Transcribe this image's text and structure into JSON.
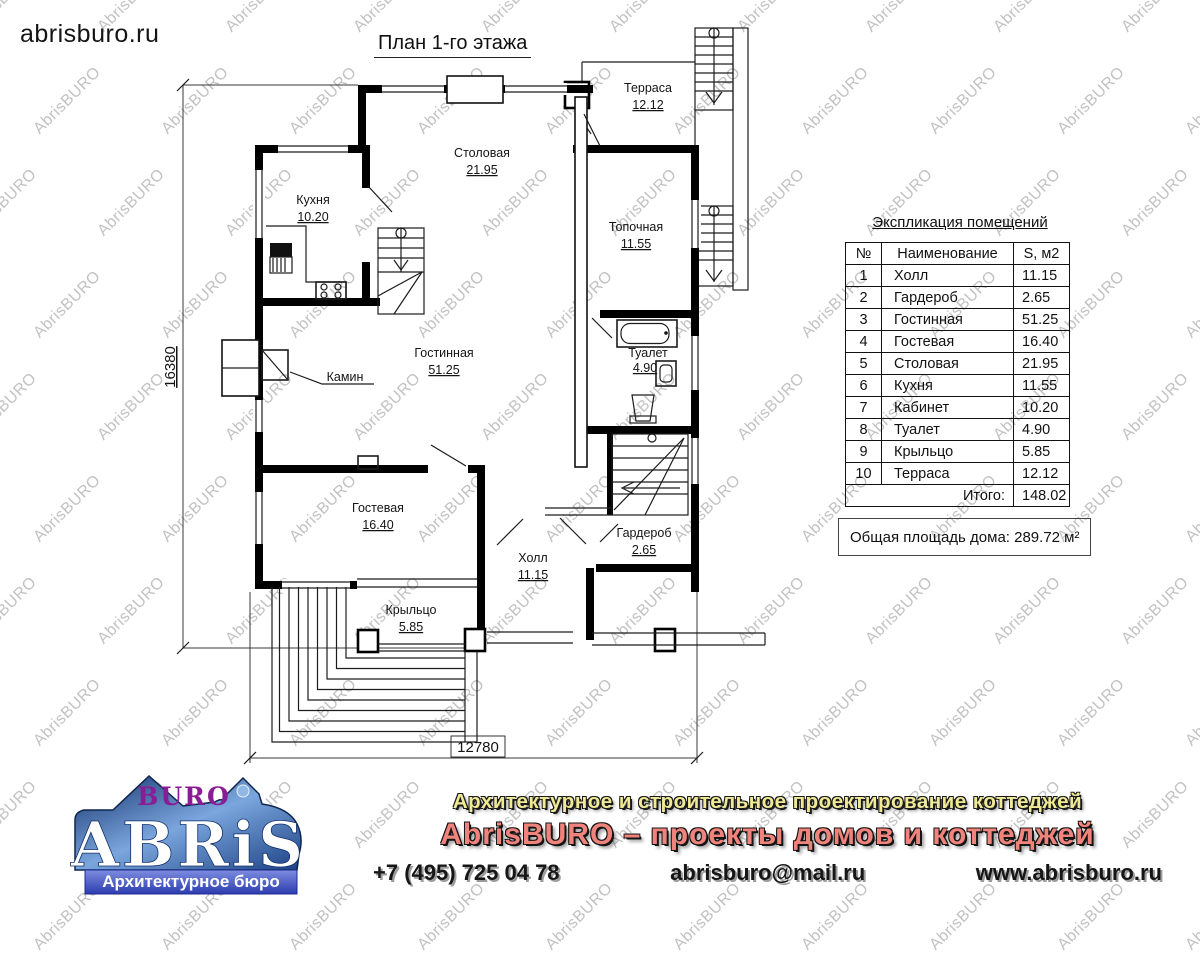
{
  "header": {
    "site": "abrisburo.ru",
    "title": "План 1-го этажа"
  },
  "watermark": {
    "text": "AbrisBURO",
    "color": "#c2c2c2"
  },
  "plan": {
    "dims": {
      "height": "16380",
      "width": "12780"
    },
    "labels": {
      "terrace": {
        "name": "Терраса",
        "area": "12.12"
      },
      "dining": {
        "name": "Столовая",
        "area": "21.95"
      },
      "kitchen": {
        "name": "Кухня",
        "area": "10.20"
      },
      "boiler": {
        "name": "Топочная",
        "area": "11.55"
      },
      "living": {
        "name": "Гостинная",
        "area": "51.25"
      },
      "fireplace": {
        "name": "Камин"
      },
      "toilet": {
        "name": "Туалет",
        "area": "4.90"
      },
      "guest": {
        "name": "Гостевая",
        "area": "16.40"
      },
      "hall": {
        "name": "Холл",
        "area": "11.15"
      },
      "wardrobe": {
        "name": "Гардероб",
        "area": "2.65"
      },
      "porch": {
        "name": "Крыльцо",
        "area": "5.85"
      }
    }
  },
  "explication": {
    "title": "Экспликация помещений",
    "headers": [
      "№",
      "Наименование",
      "S, м2"
    ],
    "rows": [
      [
        "1",
        "Холл",
        "11.15"
      ],
      [
        "2",
        "Гардероб",
        "2.65"
      ],
      [
        "3",
        "Гостинная",
        "51.25"
      ],
      [
        "4",
        "Гостевая",
        "16.40"
      ],
      [
        "5",
        "Столовая",
        "21.95"
      ],
      [
        "6",
        "Кухня",
        "11.55"
      ],
      [
        "7",
        "Кабинет",
        "10.20"
      ],
      [
        "8",
        "Туалет",
        "4.90"
      ],
      [
        "9",
        "Крыльцо",
        "5.85"
      ],
      [
        "10",
        "Терраса",
        "12.12"
      ]
    ],
    "total_label": "Итого:",
    "total_value": "148.02"
  },
  "summary": {
    "text": "Общая площадь дома: 289.72 м²"
  },
  "footer": {
    "logo": {
      "top": "BURO",
      "main": "ABRiS",
      "ribbon": "Архитектурное бюро"
    },
    "tagline": "Архитектурное и строительное проектирование коттеджей",
    "slogan": "AbrisBURO – проекты домов и коттеджей",
    "phone": "+7 (495) 725 04 78",
    "email": "abrisburo@mail.ru",
    "website": "www.abrisburo.ru",
    "colors": {
      "tagline": "#f0ea96",
      "slogan": "#f0837c",
      "contacts": "#1b1b1b",
      "logo_blue": "#1c4184",
      "logo_purple": "#8a1d96"
    }
  }
}
